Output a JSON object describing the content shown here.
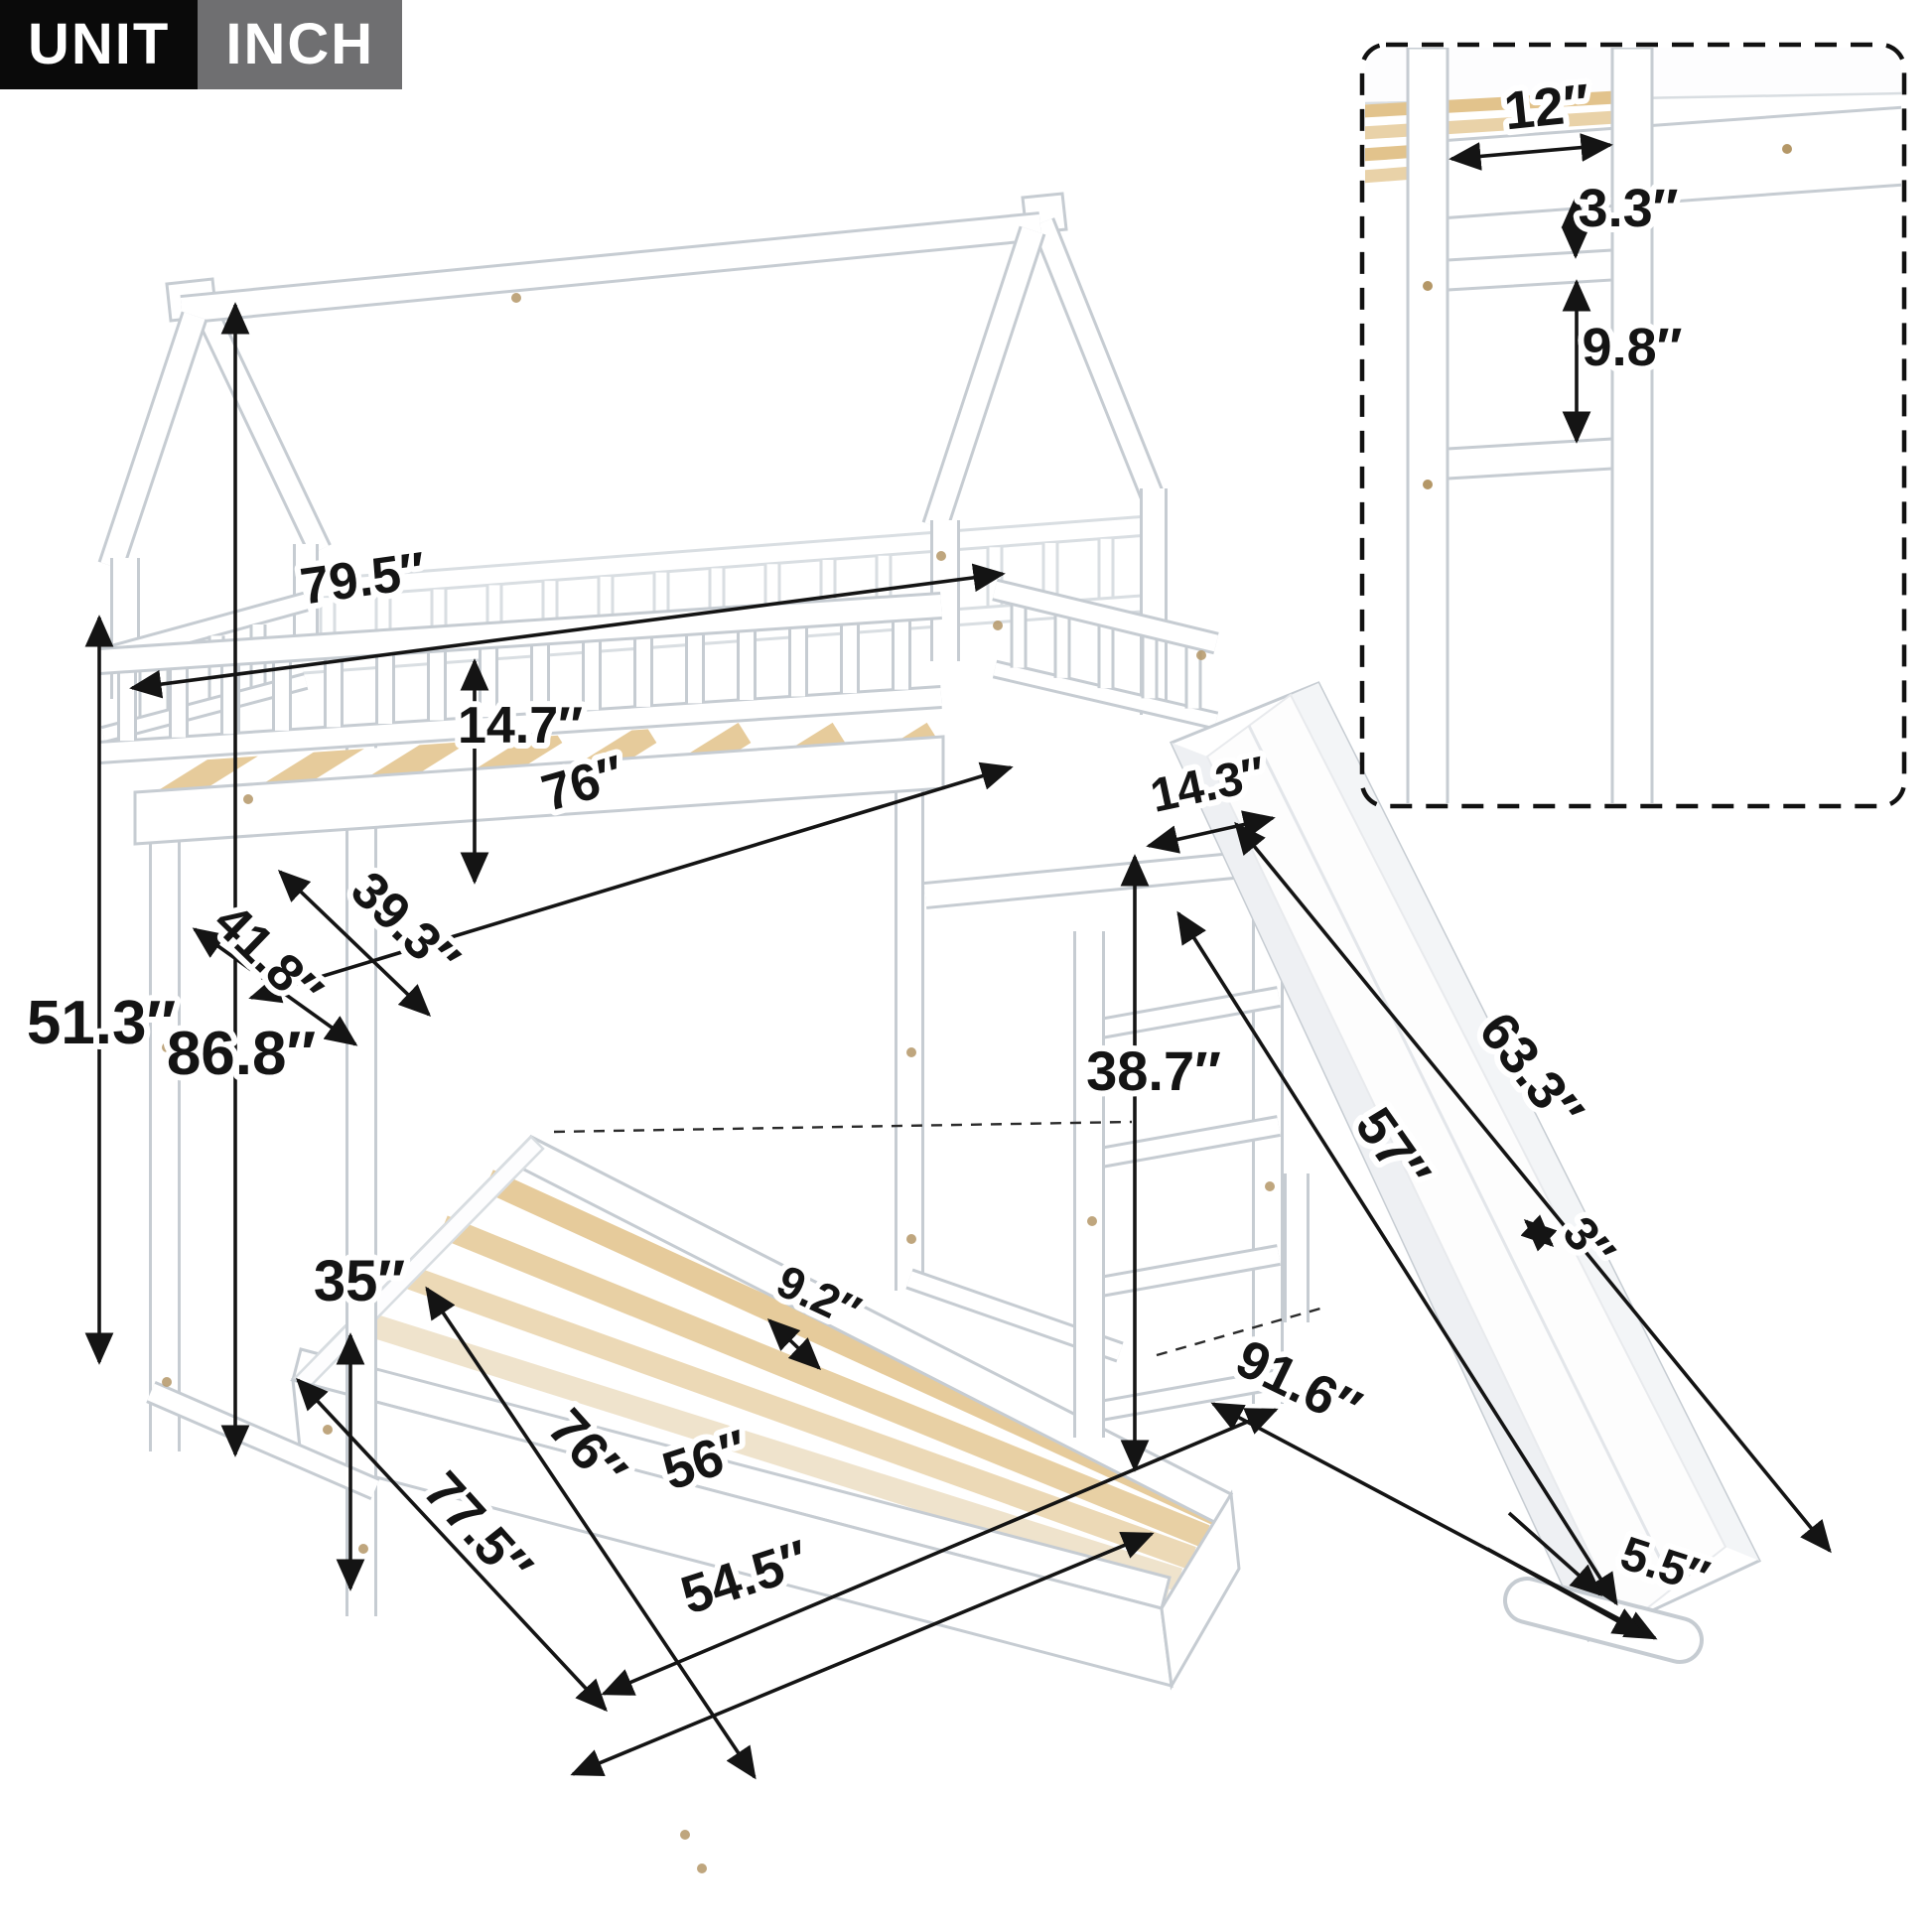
{
  "badge": {
    "unit": "UNIT",
    "inch": "INCH"
  },
  "colors": {
    "badge_unit_bg": "#0a0a0a",
    "badge_inch_bg": "#6f6f71",
    "dimension_line": "#141414",
    "frame_stroke": "#c6ccd2",
    "wood_slat": "#e6cb9b",
    "wood_slat_pale": "#efe7d8",
    "screw": "#b49767"
  },
  "dimensions": {
    "overall_length": "79.5″",
    "rail_height": "14.7″",
    "upper_bed_length": "76″",
    "upper_bed_width": "39.3″",
    "upper_outer_width": "41.8″",
    "left_height": "51.3″",
    "total_height": "86.8″",
    "lower_clearance": "35″",
    "slide_gap": "14.3″",
    "under_bunk_height": "38.7″",
    "slat_spacing": "9.2″",
    "lower_bed_length": "76″",
    "lower_inner_width": "56″",
    "lower_outer_length": "77.5″",
    "lower_bed_width": "54.5″",
    "total_footprint": "91.6″",
    "slide_length": "57″",
    "slide_outer_length": "63.3″",
    "slide_rail_height": "3″",
    "slide_foot_width": "5.5″"
  },
  "inset": {
    "ladder_width": "12″",
    "rung_gap_top": "3.3″",
    "rung_gap": "9.8″"
  }
}
